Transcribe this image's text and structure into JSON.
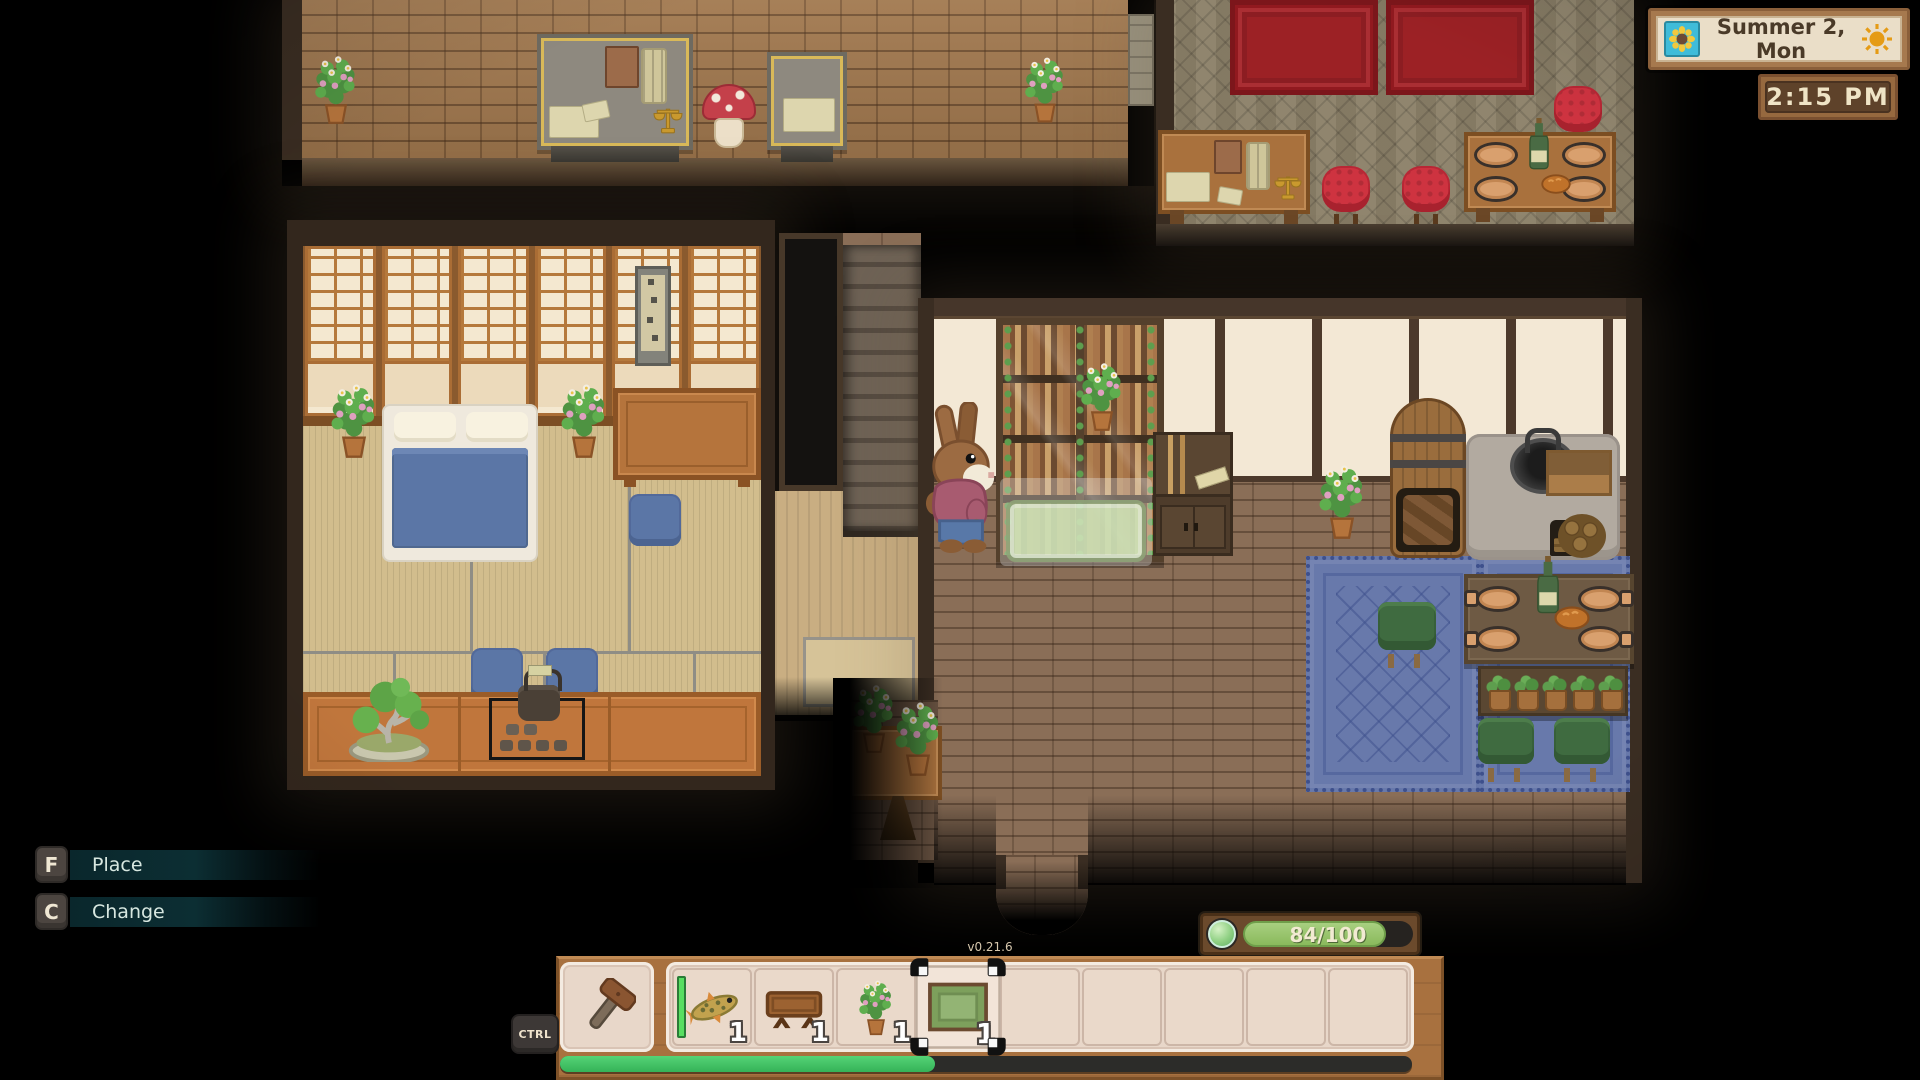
{
  "hud": {
    "date_panel": {
      "date": "Summer 2, Mon",
      "season_icon": "sunflower-icon",
      "weather_icon": "sun-icon"
    },
    "time_panel": {
      "time": "2:15 PM"
    },
    "energy": {
      "label": "84/100",
      "current": 84,
      "max": 100,
      "percent": 84
    },
    "keybinds": [
      {
        "key": "F",
        "action": "Place"
      },
      {
        "key": "C",
        "action": "Change"
      }
    ],
    "hotbar": {
      "modifier_key": "CTRL",
      "version": "v0.21.6",
      "tool_slot": {
        "item": "hammer",
        "icon": "hammer-icon"
      },
      "selected_slot": 4,
      "slots": [
        {
          "item": "fish",
          "icon": "fish-icon",
          "quantity": "1",
          "durability_bar": true
        },
        {
          "item": "low wooden table",
          "icon": "table-icon",
          "quantity": "1"
        },
        {
          "item": "potted plant",
          "icon": "potted-plant-icon",
          "quantity": "1"
        },
        {
          "item": "green rug",
          "icon": "rug-icon",
          "quantity": "1",
          "selected": true
        },
        {
          "item": null,
          "quantity": null
        },
        {
          "item": null,
          "quantity": null
        },
        {
          "item": null,
          "quantity": null
        },
        {
          "item": null,
          "quantity": null
        },
        {
          "item": null,
          "quantity": null
        }
      ],
      "progress_percent": 44
    }
  },
  "scene": {
    "placement_preview_item": "green rug",
    "player": "rabbit villager"
  },
  "colors": {
    "energy_fill": "#8aba5c",
    "progress_fill": "#3fc465",
    "hud_wood": "#a8713f",
    "keyhint_bg": "#0c2d32",
    "date_face": "#eadec8",
    "durability_green": "#58de61"
  }
}
